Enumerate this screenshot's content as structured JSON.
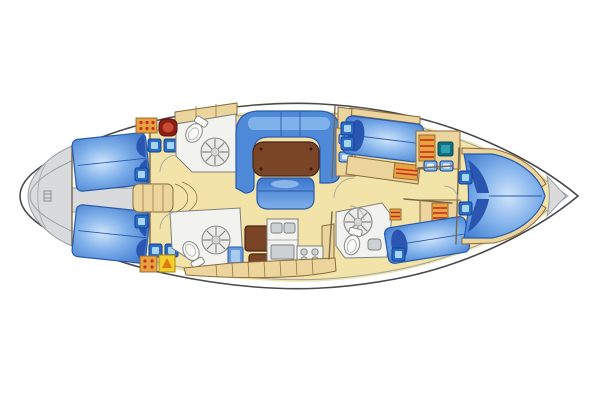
{
  "diagram": {
    "type": "sailing-yacht-interior-deck-plan",
    "labels": {
      "hull": "hull outline",
      "stern_transom": "stern transom deck",
      "aft_cabin_top": "aft double cabin (starboard) with berth",
      "aft_cabin_bottom": "aft double cabin (port) with berth",
      "aft_corridor": "aft companionway corridor",
      "companionway": "companionway steps",
      "head_top": "aft head with toilet and shower",
      "head_bottom": "aft head with toilet and shower",
      "saloon_settee": "U-shaped saloon settee",
      "saloon_table": "saloon table",
      "saloon_stool": "movable saloon seat",
      "nav_station": "chart table / nav station",
      "galley": "galley with double sink and stove",
      "fwd_cabin_top": "forward guest cabin berth",
      "fwd_cabin_bottom": "forward guest cabin berth",
      "fwd_head": "forward head with shower",
      "v_berth": "owner V-berth cabin",
      "anchor_locker": "bow anchor locker"
    },
    "colors": {
      "bg": "#ffffff",
      "hull_fill": "#ffffff",
      "hull_stroke": "#4a4a4a",
      "deck_gray": "#d8dadb",
      "deck_line": "#9aa0a4",
      "floor_yellow": "#f2e3a9",
      "furniture_tan": "#ecd59c",
      "furniture_stroke": "#8a6a3a",
      "wood_brown": "#7a4527",
      "wood_stroke": "#4a2512",
      "berth_blue": "#3a76cc",
      "berth_mid": "#7fb0ea",
      "berth_light": "#cfe4fb",
      "pillow_blue": "#2a55b0",
      "settee_blue": "#4f8ad8",
      "settee_light": "#7fb2ea",
      "hatch_blue": "#2a6cc8",
      "hatch_light": "#a8d4f0",
      "hatch_stroke": "#16408c",
      "fixture_white": "#f2f2ee",
      "fixture_stroke": "#7f7f7f",
      "appliance_gray": "#ccd1d5",
      "accent_red": "#c23024",
      "sink_red_dark": "#8c1f14",
      "sink_red_light": "#c84a30",
      "locker_orange": "#e8a23e",
      "box_yellow": "#f0d02a",
      "tri_orange": "#e07818",
      "teal_dark": "#0f6f7f",
      "teal_light": "#2fa0b0",
      "wall_stroke": "#77694f"
    }
  }
}
